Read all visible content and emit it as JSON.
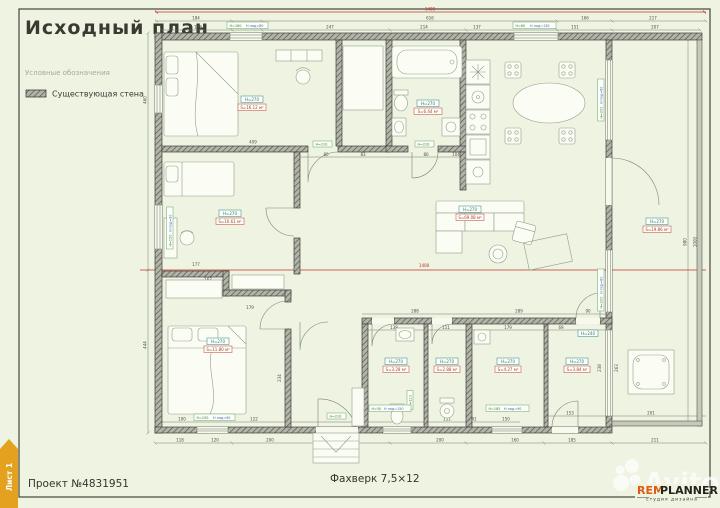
{
  "page": {
    "title": "Исходный план",
    "legend_title": "Условные обозначения",
    "legend_wall": "Существующая стена",
    "project": "Проект №4831951",
    "footer_center": "Фахверк 7,5×12",
    "sheet_tab": "Лист 1",
    "watermark": "Avito",
    "logo": {
      "rem": "REM",
      "planner": "PLANNER",
      "subtitle": "студия дизайна"
    }
  },
  "colors": {
    "background": "#eef3e2",
    "accent_red": "#c03226",
    "tab_orange": "#e3a11d",
    "logo_orange": "#e05a10",
    "badge_teal": "#2c7b7b",
    "area_red": "#b03a2a"
  },
  "plan": {
    "rooms": [
      {
        "name": "bedroom-1",
        "h": "H=270",
        "s": "S=16.12 м²"
      },
      {
        "name": "bathroom-1",
        "h": "H=270",
        "s": "S=6.44 м²"
      },
      {
        "name": "living-kitchen",
        "h": "H=270",
        "s": "S=69.08 м²"
      },
      {
        "name": "terrace",
        "h": "H=270",
        "s": "S=19.86 м²"
      },
      {
        "name": "office",
        "h": "H=270",
        "s": "S=10.61 м²"
      },
      {
        "name": "bedroom-2",
        "h": "H=270",
        "s": "S=11.80 м²"
      },
      {
        "name": "wc-1",
        "h": "H=270",
        "s": "S=3.28 м²"
      },
      {
        "name": "wc-2",
        "h": "H=270",
        "s": "S=2.88 м²"
      },
      {
        "name": "hall",
        "h": "H=270",
        "s": "S=4.27 м²"
      },
      {
        "name": "laundry",
        "h": "H=270",
        "s": "S=3.84 м²"
      }
    ],
    "badge_h240": "H=240",
    "doors": [
      "H=210",
      "H=210",
      "H=210",
      "H=210"
    ],
    "win": [
      {
        "h": "H=180",
        "p": "H под=80"
      },
      {
        "h": "H=60",
        "p": "H под=130"
      },
      {
        "h": "H=150",
        "p": "H под=90"
      },
      {
        "h": "H=50",
        "p": "H под=150"
      },
      {
        "h": "H=185",
        "p": "H под=90"
      },
      {
        "h": "H=200",
        "p": "H под=60"
      },
      {
        "h": "H=200",
        "p": "H под=60"
      },
      {
        "h": "H=150",
        "p": "H под=90"
      }
    ],
    "dims": [
      "1408",
      "1408",
      "184",
      "616",
      "166",
      "217",
      "188",
      "120",
      "247",
      "214",
      "137",
      "151",
      "207",
      "460",
      "444",
      "980",
      "1000",
      "409",
      "343",
      "80",
      "83",
      "80",
      "104",
      "288",
      "289",
      "138",
      "111",
      "179",
      "69",
      "90",
      "100",
      "120",
      "122",
      "111",
      "41",
      "150",
      "153",
      "201",
      "118",
      "120",
      "200",
      "50",
      "200",
      "160",
      "185",
      "211",
      "112",
      "234",
      "263",
      "238",
      "177",
      "167",
      "168",
      "179"
    ]
  }
}
